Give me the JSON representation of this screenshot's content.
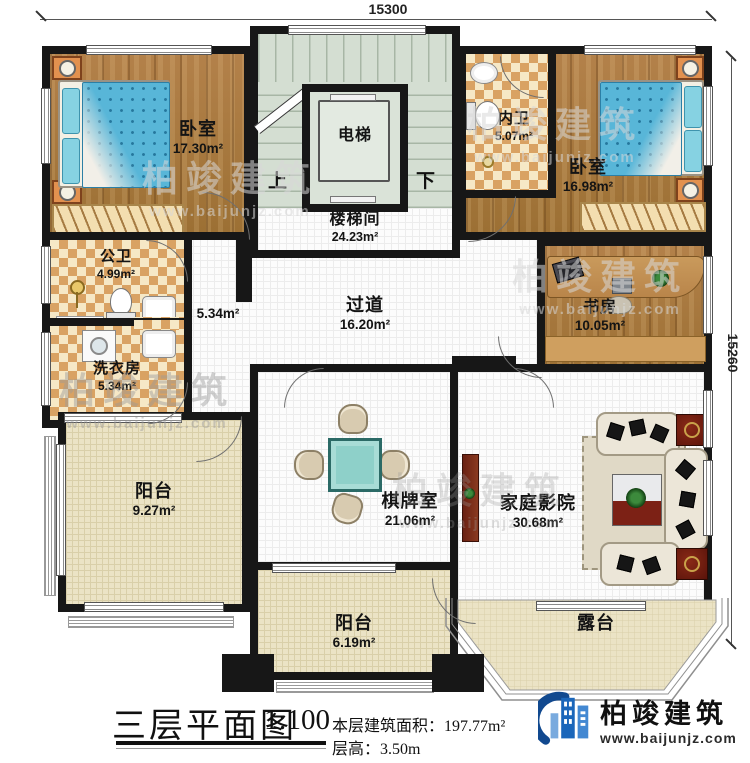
{
  "dimensions": {
    "top": "15300",
    "right": "15260"
  },
  "stairs": {
    "up": "上",
    "down": "下"
  },
  "rooms": {
    "bedroom1": {
      "name": "卧室",
      "area": "17.30m²"
    },
    "elevator": {
      "name": "电梯"
    },
    "stairwell": {
      "name": "楼梯间",
      "area": "24.23m²"
    },
    "inner_bath": {
      "name": "内卫",
      "area": "5.07m²"
    },
    "bedroom2": {
      "name": "卧室",
      "area": "16.98m²"
    },
    "public_bath": {
      "name": "公卫",
      "area": "4.99m²"
    },
    "west_hall": {
      "area": "5.34m²"
    },
    "laundry": {
      "name": "洗衣房",
      "area": "5.34m²"
    },
    "corridor": {
      "name": "过道",
      "area": "16.20m²"
    },
    "study": {
      "name": "书房",
      "area": "10.05m²"
    },
    "balcony_west": {
      "name": "阳台",
      "area": "9.27m²"
    },
    "chess_room": {
      "name": "棋牌室",
      "area": "21.06m²"
    },
    "home_theater": {
      "name": "家庭影院",
      "area": "30.68m²"
    },
    "balcony_south": {
      "name": "阳台",
      "area": "6.19m²"
    },
    "terrace": {
      "name": "露台"
    }
  },
  "caption": {
    "title": "三层平面图",
    "scale": "1:100",
    "area_label": "本层建筑面积：",
    "area_value": "197.77m²",
    "height_label": "层高：",
    "height_value": "3.50m"
  },
  "brand": {
    "name": "柏竣建筑",
    "site": "www.baijunjz.com"
  },
  "watermark": {
    "name": "柏竣建筑",
    "site": "www.baijunjz.com"
  }
}
